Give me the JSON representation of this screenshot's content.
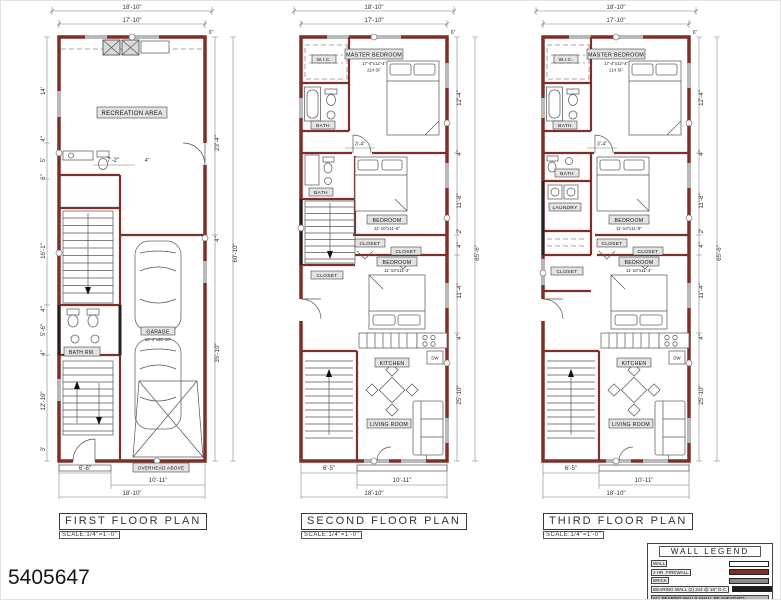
{
  "sheet": {
    "number": "5405647"
  },
  "colors": {
    "firewall_wall": "#7E2F28",
    "bearing_wall": "#1C1C1C",
    "brick_wall": "#8A8A8A",
    "plain_wall": "#FFFFFF"
  },
  "plans": [
    {
      "title": "FIRST FLOOR PLAN",
      "scale": "SCALE:1/4\"=1'-0\"",
      "rooms": {
        "recreation": "RECREATION AREA",
        "bath": "BATH RM.",
        "garage": "GARAGE",
        "garage_size": "10'-4\"x35'-10\"",
        "overhead": "OVERHEAD ABOVE"
      },
      "dims": {
        "top": [
          "18'-10\"",
          "17'-10\""
        ],
        "left": [
          "14'",
          "4\"",
          "5'",
          "6\"",
          "16'-1\"",
          "4\"",
          "5'-6\"",
          "4\"",
          "12'-10\"",
          "3'"
        ],
        "right": [
          "6\"",
          "23'-4\"",
          "4\"",
          "35'-10\"",
          "60'-10\""
        ],
        "interior": [
          "7'-2\"",
          "4\""
        ],
        "bottom": [
          "6'-6\"",
          "10'-11\"",
          "18'-10\""
        ]
      }
    },
    {
      "title": "SECOND FLOOR PLAN",
      "scale": "SCALE:1/4\"=1'-0\"",
      "rooms": {
        "master": "MASTER BEDROOM",
        "master_size": "17'-4\"x12'-4\"",
        "master_area": "214 SF",
        "wic": "W.I.C.",
        "bath1": "BATH",
        "bath2": "BATH",
        "bedroom1": "BEDROOM",
        "bedroom1_size": "11'-10\"x11'-8\"",
        "closet1": "CLOSET",
        "closet2": "CLOSET",
        "closet3": "CLOSET",
        "bedroom2": "BEDROOM",
        "bedroom2_size": "11'-10\"x11'-4\"",
        "kitchen": "KITCHEN",
        "dw": "DW",
        "living": "LIVING ROOM"
      },
      "dims": {
        "top": [
          "18'-10\"",
          "17'-10\""
        ],
        "right": [
          "6\"",
          "12'-4\"",
          "4\"",
          "11'-8\"",
          "2'",
          "4\"",
          "11'-4\"",
          "4\"",
          "25'-10\"",
          "65'-6\""
        ],
        "interior": [
          "3'-4\""
        ],
        "bottom": [
          "6'-5\"",
          "10'-11\"",
          "18'-10\""
        ]
      }
    },
    {
      "title": "THIRD FLOOR PLAN",
      "scale": "SCALE:1/4\"=1'-0\"",
      "rooms": {
        "master": "MASTER BEDROOM",
        "master_size": "17'-4\"x12'-4\"",
        "master_area": "214 SF",
        "wic": "W.I.C.",
        "bath1": "BATH",
        "bath2": "BATH",
        "laundry": "LAUNDRY",
        "closet_hall": "CLOSET",
        "bedroom1": "BEDROOM",
        "bedroom1_size": "11'-10\"x11'-8\"",
        "closet1": "CLOSET",
        "closet2": "CLOSET",
        "bedroom2": "BEDROOM",
        "bedroom2_size": "11'-10\"x11'-4\"",
        "kitchen": "KITCHEN",
        "dw": "DW",
        "living": "LIVING ROOM"
      },
      "dims": {
        "top": [
          "18'-10\"",
          "17'-10\""
        ],
        "right": [
          "6\"",
          "12'-4\"",
          "4\"",
          "11'-8\"",
          "2'",
          "4\"",
          "11'-4\"",
          "4\"",
          "25'-10\"",
          "65'-6\""
        ],
        "interior": [
          "3'-4\""
        ],
        "bottom": [
          "6'-5\"",
          "10'-11\"",
          "18'-10\""
        ]
      }
    }
  ],
  "legend": {
    "title": "WALL LEGEND",
    "rows": [
      {
        "label": "WALL",
        "color": "#FFFFFF"
      },
      {
        "label": "2 HR. FIREWALL",
        "color": "#7E2F28"
      },
      {
        "label": "BRICK",
        "color": "#8A8A8A"
      },
      {
        "label": "BEARING WALL (2) 2x4 @ 16\" O.C.",
        "color": "#1C1C1C"
      }
    ],
    "note": "ALL BEARING WALLS SHALL BE SHEATHED"
  }
}
